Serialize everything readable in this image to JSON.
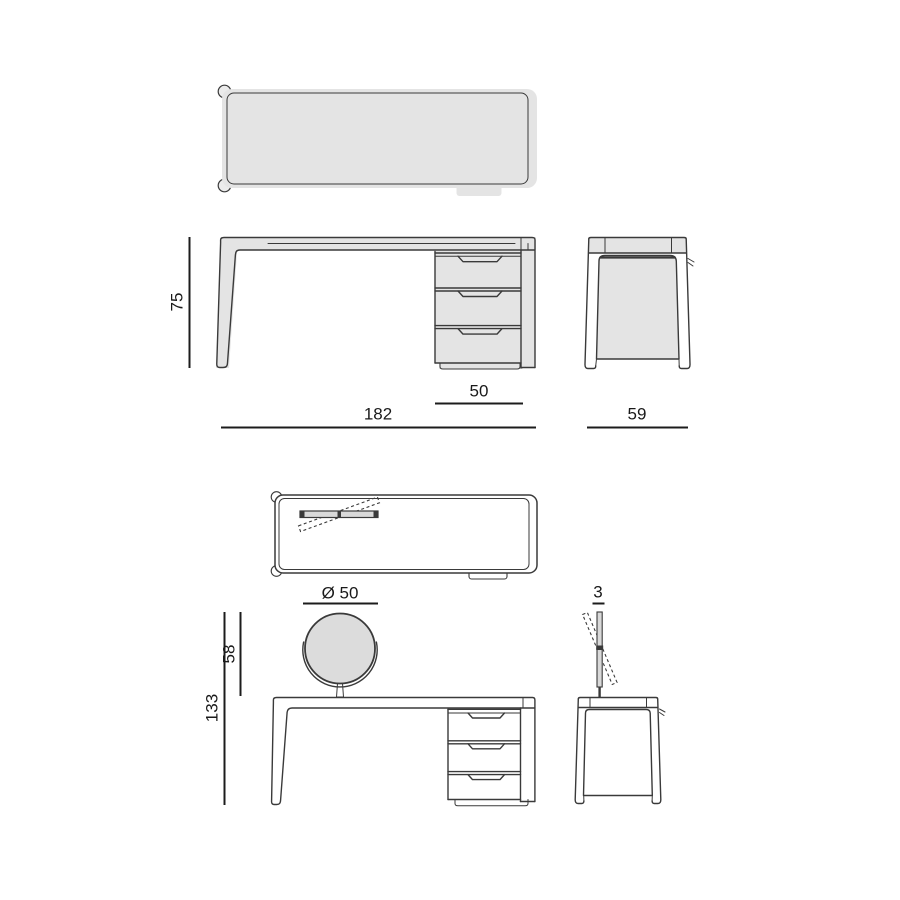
{
  "document_type": "furniture technical drawing, desk with drawer unit and round vanity mirror, six orthographic views",
  "dimensions": {
    "desk_height": "75",
    "desk_width": "182",
    "drawer_unit_width": "50",
    "desk_depth": "59",
    "mirror_diameter": "Ø 50",
    "mirror_height_above_top": "58",
    "total_height": "133",
    "mirror_thickness": "3"
  },
  "colors": {
    "background": "#ffffff",
    "outline": "#3a3a3a",
    "dimension_line": "#1c1c1c",
    "label_text": "#1a1a1a",
    "surface_fill": "#e4e4e4",
    "mirror_fill": "#dcdcdc",
    "mirror_bar_fill": "#d9d9d9"
  }
}
